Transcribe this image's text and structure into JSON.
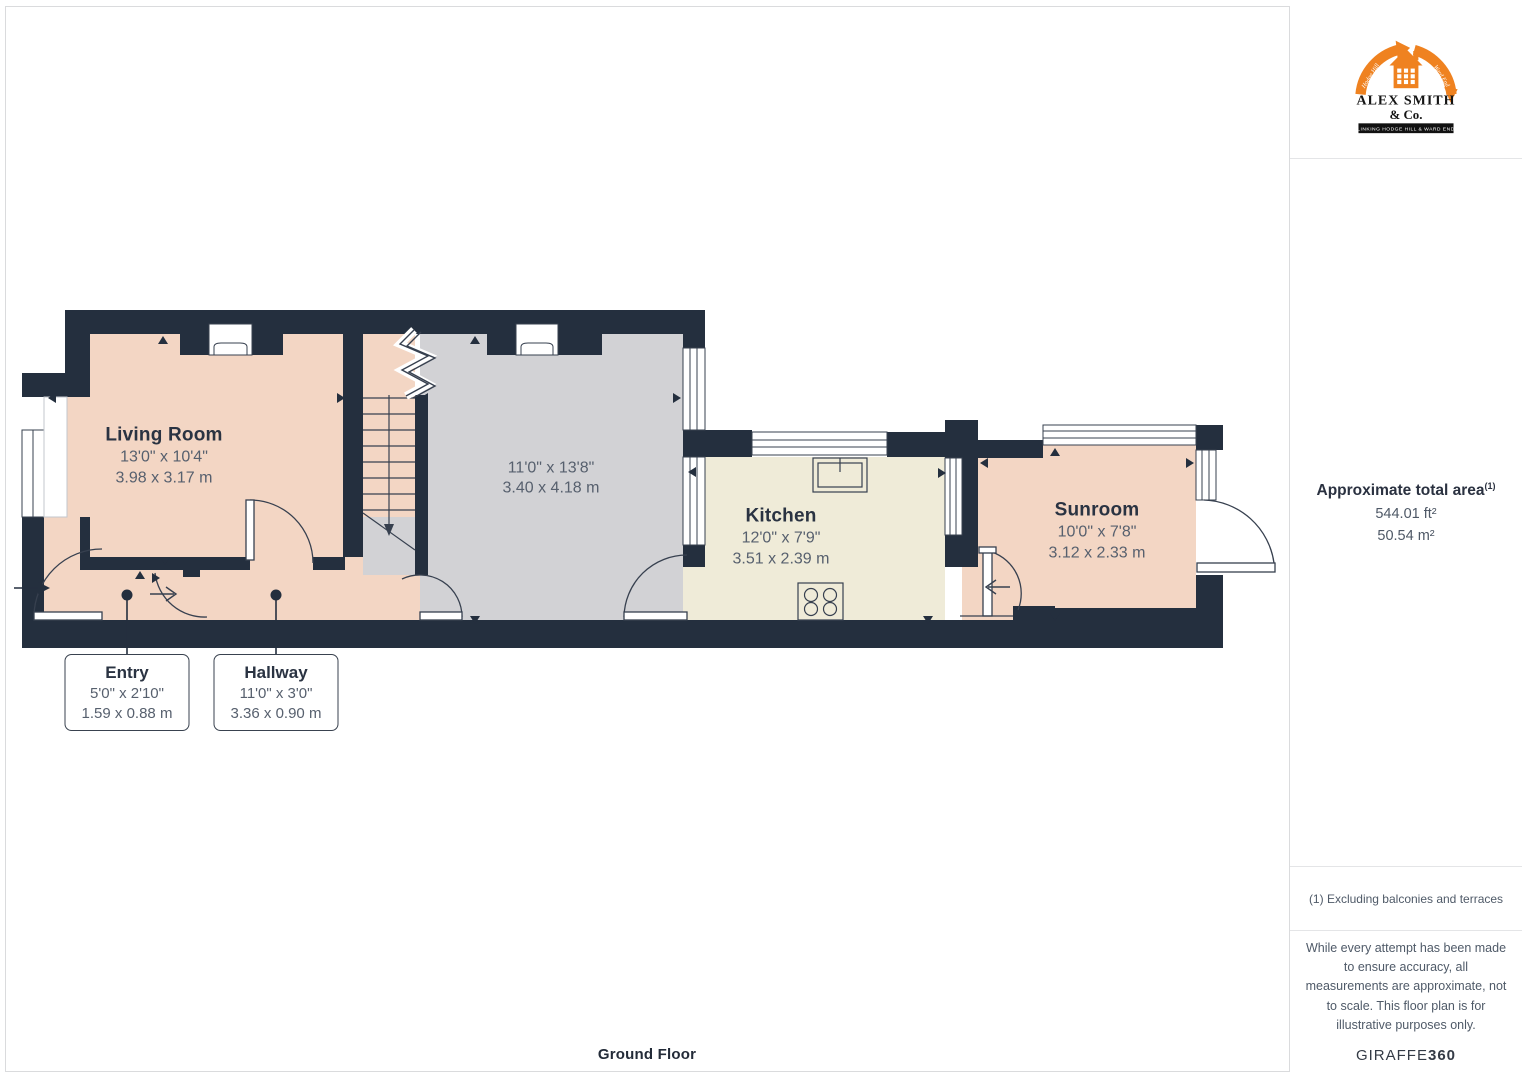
{
  "floorplan": {
    "floor_label": "Ground Floor",
    "rooms": [
      {
        "name": "Living Room",
        "imperial": "13'0\" x 10'4\"",
        "metric": "3.98 x 3.17 m"
      },
      {
        "imperial": "11'0\" x 13'8\"",
        "metric": "3.40 x 4.18 m"
      },
      {
        "name": "Kitchen",
        "imperial": "12'0\" x 7'9\"",
        "metric": "3.51 x 2.39 m"
      },
      {
        "name": "Sunroom",
        "imperial": "10'0\" x 7'8\"",
        "metric": "3.12 x 2.33 m"
      }
    ],
    "callouts": [
      {
        "name": "Entry",
        "imperial": "5'0\" x 2'10\"",
        "metric": "1.59 x 0.88 m"
      },
      {
        "name": "Hallway",
        "imperial": "11'0\" x 3'0\"",
        "metric": "3.36 x 0.90 m"
      }
    ],
    "colors": {
      "wall": "#242F3E",
      "room_pink": "#F3D6C4",
      "room_gray": "#D2D2D5",
      "room_cream": "#EFEBD8"
    }
  },
  "sidebar": {
    "logo": {
      "name": "ALEX SMITH",
      "suffix": "& Co.",
      "tagline": "LINKING HODGE HILL & WARD END",
      "ribbon_left": "Hodge Hill",
      "ribbon_right": "Ward End",
      "accent_color": "#EF8220"
    },
    "total_area": {
      "label": "Approximate total area",
      "marker": "(1)",
      "imperial": "544.01 ft²",
      "metric": "50.54 m²"
    },
    "footnote": "(1) Excluding balconies and terraces",
    "disclaimer": "While every attempt has been made to ensure accuracy, all measurements are approximate, not to scale. This floor plan is for illustrative purposes only.",
    "brand": {
      "name": "GIRAFFE",
      "suffix": "360"
    }
  }
}
